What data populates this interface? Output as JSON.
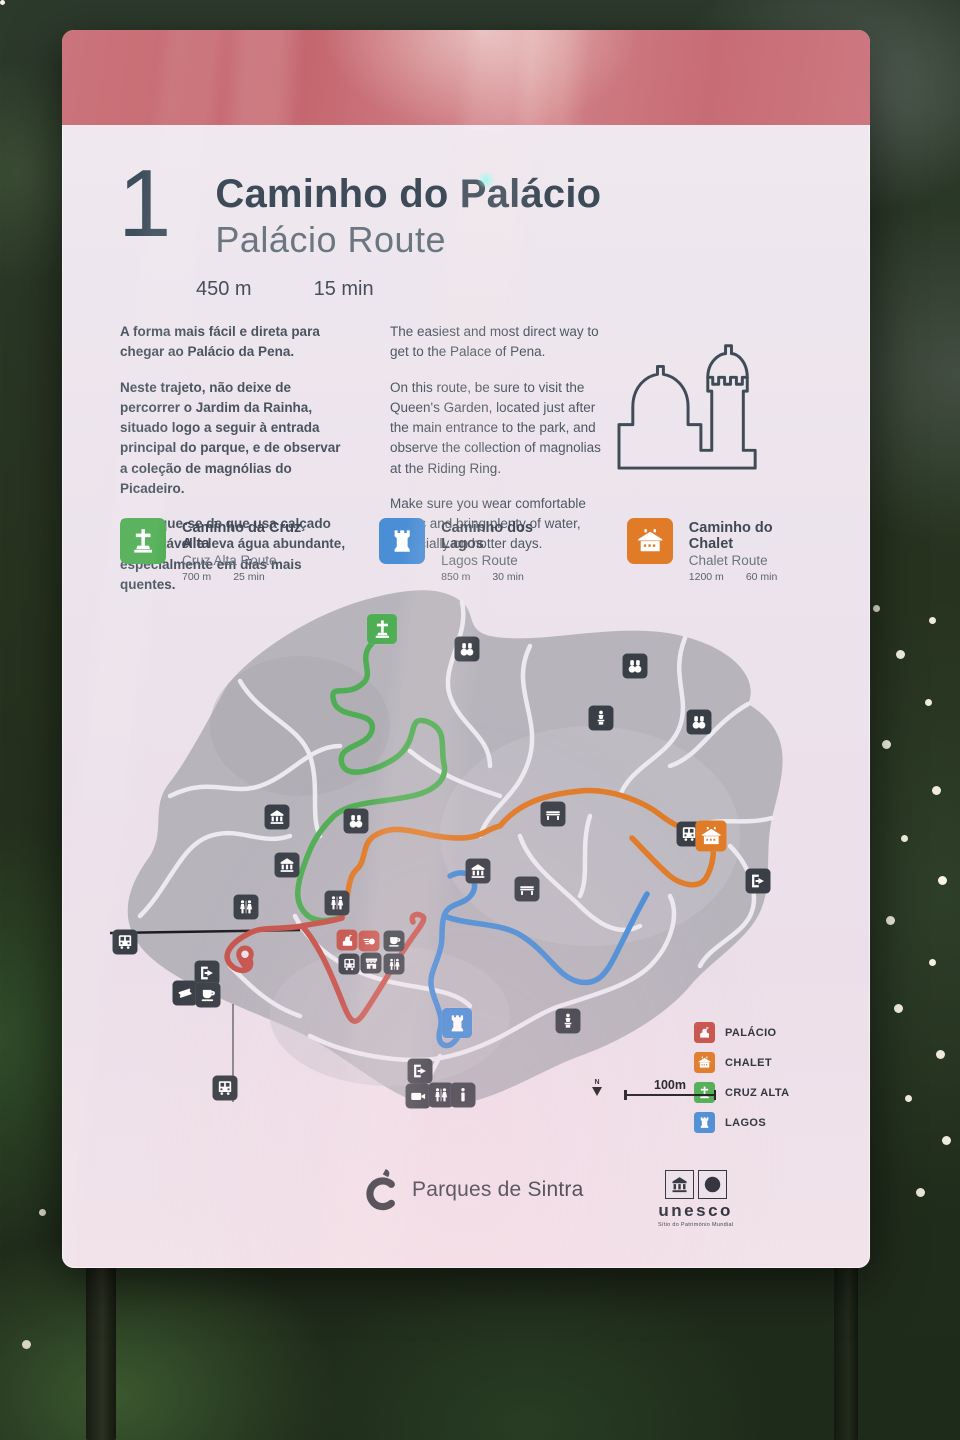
{
  "sign": {
    "number": "1",
    "title": "Caminho do Palácio",
    "subtitle": "Palácio Route",
    "distance": "450 m",
    "duration": "15 min",
    "body_pt": [
      "A forma mais fácil e direta para chegar ao Palácio da Pena.",
      "Neste trajeto, não deixe de percorrer o Jardim da Rainha, situado logo a seguir à entrada principal do parque, e de observar a coleção de magnólias do Picadeiro.",
      "Certifique-se de que usa calçado confortável e leva água abundante, especialmente em dias mais quentes."
    ],
    "body_en": [
      "The easiest and most direct way to get to the Palace of Pena.",
      "On this route, be sure to visit the Queen's Garden, located just after the main entrance to the park, and observe the collection of magnolias at the Riding Ring.",
      "Make sure you wear comfortable shoes and bring plenty of water, especially on hotter days."
    ]
  },
  "other_routes": [
    {
      "name": "Caminho da Cruz Alta",
      "subname": "Cruz Alta Route",
      "distance": "700 m",
      "duration": "25 min",
      "color": "#4fae53",
      "icon": "cross"
    },
    {
      "name": "Caminho dos Lagos",
      "subname": "Lagos Route",
      "distance": "850 m",
      "duration": "30 min",
      "color": "#4a8ed6",
      "icon": "tower"
    },
    {
      "name": "Caminho do Chalet",
      "subname": "Chalet Route",
      "distance": "1200 m",
      "duration": "60 min",
      "color": "#e07b28",
      "icon": "chalet"
    }
  ],
  "map": {
    "legend": [
      {
        "label": "PALÁCIO",
        "color": "#c6534b",
        "icon": "palace"
      },
      {
        "label": "CHALET",
        "color": "#e07b28",
        "icon": "chalet"
      },
      {
        "label": "CRUZ ALTA",
        "color": "#4fae53",
        "icon": "cross"
      },
      {
        "label": "LAGOS",
        "color": "#4a8ed6",
        "icon": "tower"
      }
    ],
    "scale_label": "100m",
    "north_label": "N",
    "pois": [
      {
        "icon": "binoculars",
        "x": 357,
        "y": 63
      },
      {
        "icon": "binoculars",
        "x": 525,
        "y": 80
      },
      {
        "icon": "statue",
        "x": 491,
        "y": 132
      },
      {
        "icon": "binoculars",
        "x": 589,
        "y": 136
      },
      {
        "icon": "museum",
        "x": 167,
        "y": 231
      },
      {
        "icon": "binoculars",
        "x": 246,
        "y": 235
      },
      {
        "icon": "bench",
        "x": 443,
        "y": 228
      },
      {
        "icon": "museum",
        "x": 177,
        "y": 279
      },
      {
        "icon": "museum",
        "x": 368,
        "y": 285
      },
      {
        "icon": "bench",
        "x": 417,
        "y": 303
      },
      {
        "icon": "wc",
        "x": 136,
        "y": 321
      },
      {
        "icon": "wc",
        "x": 227,
        "y": 317
      },
      {
        "icon": "bus",
        "x": 15,
        "y": 356
      },
      {
        "icon": "exit",
        "x": 97,
        "y": 387
      },
      {
        "icon": "ticket",
        "x": 75,
        "y": 407
      },
      {
        "icon": "cafe",
        "x": 98,
        "y": 409
      },
      {
        "icon": "palace",
        "x": 237,
        "y": 354,
        "color": "#c6534b",
        "size": 21
      },
      {
        "icon": "tickets",
        "x": 259,
        "y": 355,
        "color": "#c6534b",
        "size": 21
      },
      {
        "icon": "cafe",
        "x": 284,
        "y": 355,
        "size": 21
      },
      {
        "icon": "bus",
        "x": 239,
        "y": 378,
        "size": 21
      },
      {
        "icon": "shop",
        "x": 261,
        "y": 377,
        "size": 21
      },
      {
        "icon": "wc",
        "x": 284,
        "y": 378,
        "size": 21
      },
      {
        "icon": "statue",
        "x": 458,
        "y": 435
      },
      {
        "icon": "exit",
        "x": 310,
        "y": 485
      },
      {
        "icon": "camera",
        "x": 308,
        "y": 510
      },
      {
        "icon": "wc",
        "x": 331,
        "y": 509
      },
      {
        "icon": "info",
        "x": 353,
        "y": 509
      },
      {
        "icon": "bus",
        "x": 115,
        "y": 502
      },
      {
        "icon": "bus",
        "x": 579,
        "y": 248
      },
      {
        "icon": "exit",
        "x": 648,
        "y": 295
      },
      {
        "icon": "cross",
        "x": 272,
        "y": 43,
        "color": "#4fae53",
        "size": 30
      },
      {
        "icon": "chalet",
        "x": 601,
        "y": 250,
        "color": "#e07b28",
        "size": 31
      },
      {
        "icon": "tower",
        "x": 347,
        "y": 437,
        "color": "#4a8ed6",
        "size": 30
      },
      {
        "icon": "pin",
        "x": 135,
        "y": 372,
        "size": 30
      }
    ]
  },
  "footer": {
    "brand": "Parques de Sintra",
    "unesco_name": "unesco",
    "unesco_caption": "Sítio do Património Mundial"
  },
  "colors": {
    "band": "#c86e76",
    "palacio_route": "#c6534b",
    "chalet_route": "#e07b28",
    "cruz_alta_route": "#4fae53",
    "lagos_route": "#4a8ed6",
    "poi_box": "#3a3f47",
    "map_ground": "#b7b4bc"
  }
}
